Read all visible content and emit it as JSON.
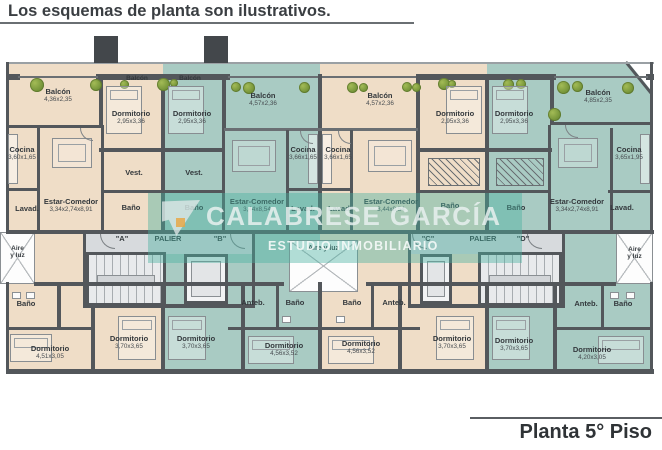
{
  "title": "Los esquemas de planta son ilustrativos.",
  "footer": "Planta 5° Piso",
  "watermark": {
    "line1": "CALABRESE GARCÍA",
    "line2": "ESTUDIO INMOBILIARIO"
  },
  "colors": {
    "unit_warm": "#efddc7",
    "unit_cool": "#a9cbc3",
    "wall": "#53575b",
    "palier": "#d7dadd",
    "watermark": "#48b0a0",
    "tree": "#7a9a3c"
  },
  "cores": {
    "left": {
      "unit_a": "\"A\"",
      "palier": "PALIER",
      "unit_b": "\"B\""
    },
    "right": {
      "unit_c": "\"C\"",
      "palier": "PALIER",
      "unit_d": "\"D\""
    }
  },
  "wells": {
    "left": "Aire\ny luz",
    "center": "Aire y luz",
    "right": "Aire\ny luz"
  },
  "rooms": {
    "a": {
      "balcon": {
        "label": "Balcón",
        "dims": "4,36x2,35"
      },
      "balcon_small": {
        "label": "Balcón"
      },
      "dorm1": {
        "label": "Dormitorio",
        "dims": "2,95x3,36"
      },
      "cocina": {
        "label": "Cocina",
        "dims": "3,60x1,65"
      },
      "vest": {
        "label": "Vest."
      },
      "estar": {
        "label": "Estar-Comedor",
        "dims": "3,34x2,74x8,91"
      },
      "lavad": {
        "label": "Lavad."
      },
      "banio_mid": {
        "label": "Baño"
      },
      "banio_bottom": {
        "label": "Baño"
      },
      "dorm2": {
        "label": "Dormitorio",
        "dims": "4,51x3,05"
      },
      "dorm3": {
        "label": "Dormitorio",
        "dims": "3,70x3,65"
      }
    },
    "b": {
      "balcon_small": {
        "label": "Balcón"
      },
      "dorm1": {
        "label": "Dormitorio",
        "dims": "2,95x3,36"
      },
      "balcon": {
        "label": "Balcón",
        "dims": "4,57x2,36"
      },
      "cocina": {
        "label": "Cocina",
        "dims": "3,66x1,65"
      },
      "vest": {
        "label": "Vest."
      },
      "banio_mid": {
        "label": "Baño"
      },
      "estar": {
        "label": "Estar-Comedor",
        "dims": "3,44x8,54"
      },
      "lavad": {
        "label": "Lavad."
      },
      "anteb": {
        "label": "Anteb."
      },
      "banio_bottom": {
        "label": "Baño"
      },
      "dorm2": {
        "label": "Dormitorio",
        "dims": "3,70x3,65"
      },
      "dorm3": {
        "label": "Dormitorio",
        "dims": "4,56x3,52"
      }
    },
    "c": {
      "balcon": {
        "label": "Balcón",
        "dims": "4,57x2,36"
      },
      "cocina": {
        "label": "Cocina",
        "dims": "3,66x1,65"
      },
      "dorm1": {
        "label": "Dormitorio",
        "dims": "2,95x3,36"
      },
      "banio_mid": {
        "label": "Baño"
      },
      "estar": {
        "label": "Estar-Comedor",
        "dims": "3,44x8,54"
      },
      "lavad": {
        "label": "Lavad."
      },
      "banio_bottom": {
        "label": "Baño"
      },
      "anteb": {
        "label": "Anteb."
      },
      "dorm2": {
        "label": "Dormitorio",
        "dims": "4,56x3,52"
      },
      "dorm3": {
        "label": "Dormitorio",
        "dims": "3,70x3,65"
      }
    },
    "d": {
      "dorm1": {
        "label": "Dormitorio",
        "dims": "2,95x3,36"
      },
      "balcon": {
        "label": "Balcón",
        "dims": "4,85x2,35"
      },
      "cocina": {
        "label": "Cocina",
        "dims": "3,65x1,95"
      },
      "banio_mid": {
        "label": "Baño"
      },
      "estar": {
        "label": "Estar-Comedor",
        "dims": "3,34x2,74x8,91"
      },
      "lavad": {
        "label": "Lavad."
      },
      "anteb": {
        "label": "Anteb."
      },
      "banio_bottom": {
        "label": "Baño"
      },
      "dorm2": {
        "label": "Dormitorio",
        "dims": "3,70x3,65"
      },
      "dorm3": {
        "label": "Dormitorio",
        "dims": "4,20x3,05"
      }
    }
  }
}
